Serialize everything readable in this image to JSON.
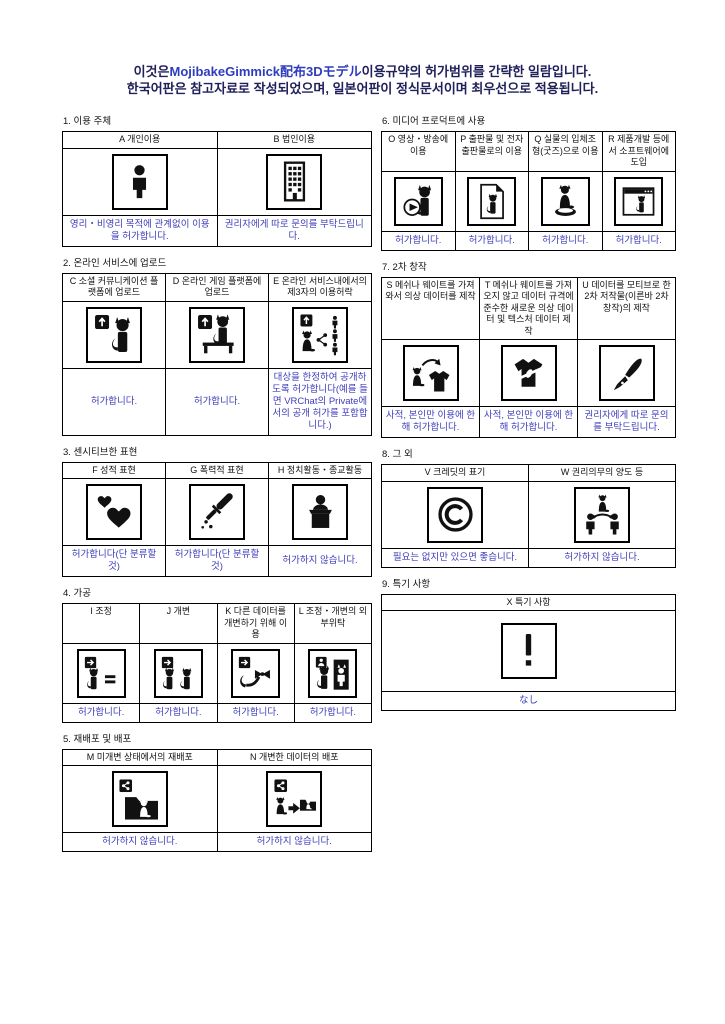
{
  "page": {
    "title_line1_prefix": "이것은",
    "title_line1_brand": "MojibakeGimmick配布3Dモデル",
    "title_line1_suffix": "이용규약의 허가범위를 간략한 일람입니다.",
    "title_line2": "한국어판은 참고자료로 작성되었으며, 일본어판이 정식문서이며 최우선으로 적용됩니다."
  },
  "colors": {
    "title_navy": "#20205a",
    "brand_blue": "#2e3cbe",
    "verdict_blue": "#3d3dba",
    "pictogram_black": "#111111"
  },
  "sections": [
    {
      "title": "1. 이용 주체",
      "cells": [
        {
          "id": "A",
          "header": "A 개인이용",
          "icon": "person-icon",
          "verdict": "영리・비영리 목적에 관계없이 이용을 허가합니다."
        },
        {
          "id": "B",
          "header": "B 법인이용",
          "icon": "building-icon",
          "verdict": "권리자에게 따로 문의를 부탁드립니다."
        }
      ]
    },
    {
      "title": "2. 온라인 서비스에 업로드",
      "cells": [
        {
          "id": "C",
          "header": "C 소셜 커뮤니케이션 플랫폼에 업로드",
          "icon": "upload-social-cat-icon",
          "verdict": "허가합니다."
        },
        {
          "id": "D",
          "header": "D 온라인 게임 플랫폼에 업로드",
          "icon": "upload-game-cat-icon",
          "verdict": "허가합니다."
        },
        {
          "id": "E",
          "header": "E 온라인 서비스내에서의 제3자의 이용허락",
          "icon": "upload-share-users-icon",
          "verdict": "대상을 한정하여 공개하도록 허가합니다(예를 들면 VRChat의 Private에서의 공개 허가를 포함합니다.)"
        }
      ]
    },
    {
      "title": "3. 센시티브한 표현",
      "cells": [
        {
          "id": "F",
          "header": "F 성적 표현",
          "icon": "hearts-icon",
          "verdict": "허가합니다(단 분류할 것)"
        },
        {
          "id": "G",
          "header": "G 폭력적 표현",
          "icon": "knife-icon",
          "verdict": "허가합니다(단 분류할 것)"
        },
        {
          "id": "H",
          "header": "H 정치활동・종교활동",
          "icon": "podium-speaker-icon",
          "verdict": "허가하지 않습니다."
        }
      ]
    },
    {
      "title": "4. 가공",
      "cells": [
        {
          "id": "I",
          "header": "I 조정",
          "icon": "adjust-cat-equal-icon",
          "verdict": "허가합니다."
        },
        {
          "id": "J",
          "header": "J 개변",
          "icon": "modify-two-cats-icon",
          "verdict": "허가합니다."
        },
        {
          "id": "K",
          "header": "K 다른 데이터를 개변하기 위해 이용",
          "icon": "tail-ribbon-icon",
          "verdict": "허가합니다."
        },
        {
          "id": "L",
          "header": "L 조정・개변의 외부위탁",
          "icon": "outsourcing-doorway-icon",
          "verdict": "허가합니다."
        }
      ]
    },
    {
      "title": "5. 재배포 및 배포",
      "cells": [
        {
          "id": "M",
          "header": "M 미개변 상태에서의 재배포",
          "icon": "folder-share-cat-icon",
          "verdict": "허가하지 않습니다."
        },
        {
          "id": "N",
          "header": "N 개변한 데이터의 배포",
          "icon": "modified-folder-cat-icon",
          "verdict": "허가하지 않습니다."
        }
      ]
    },
    {
      "title": "6. 미디어 프로덕트에 사용",
      "cells": [
        {
          "id": "O",
          "header": "O 영상・방송에 이용",
          "icon": "video-play-cat-icon",
          "verdict": "허가합니다."
        },
        {
          "id": "P",
          "header": "P 출판물 및 전자출판물로의 이용",
          "icon": "document-cat-icon",
          "verdict": "허가합니다."
        },
        {
          "id": "Q",
          "header": "Q 실물의 입체조형(굿즈)으로 이용",
          "icon": "figurine-cat-icon",
          "verdict": "허가합니다."
        },
        {
          "id": "R",
          "header": "R 제품개발 등에서 소프트웨어에 도입",
          "icon": "software-window-cat-icon",
          "verdict": "허가합니다."
        }
      ]
    },
    {
      "title": "7. 2차 창작",
      "cells": [
        {
          "id": "S",
          "header": "S 메쉬나 웨이트를 가져와서 의상 데이터를 제작",
          "icon": "costume-from-cat-icon",
          "verdict": "사적, 본인만 이용에 한해 허가합니다."
        },
        {
          "id": "T",
          "header": "T 메쉬나 웨이트를 가져오지 않고 데이터 규격에 준수한 새로운 의상 데이터 및 텍스처 데이터 제작",
          "icon": "garment-ribbon-icon",
          "verdict": "사적, 본인만 이용에 한해 허가합니다."
        },
        {
          "id": "U",
          "header": "U 데이터를 모티브로 한 2차 저작물(이른바 2차 창작)의 제작",
          "icon": "fountain-pen-icon",
          "verdict": "권리자에게 따로 문의를 부탁드립니다."
        }
      ]
    },
    {
      "title": "8. 그 외",
      "cells": [
        {
          "id": "V",
          "header": "V 크레딧의 표기",
          "icon": "copyright-icon",
          "verdict": "필요는 없지만 있으면 좋습니다."
        },
        {
          "id": "W",
          "header": "W 권리의무의 양도 등",
          "icon": "rights-transfer-icon",
          "verdict": "허가하지 않습니다."
        }
      ]
    },
    {
      "title": "9. 특기 사항",
      "cells": [
        {
          "id": "X",
          "header": "X 특기 사항",
          "icon": "exclamation-icon",
          "verdict": "なし"
        }
      ]
    }
  ]
}
